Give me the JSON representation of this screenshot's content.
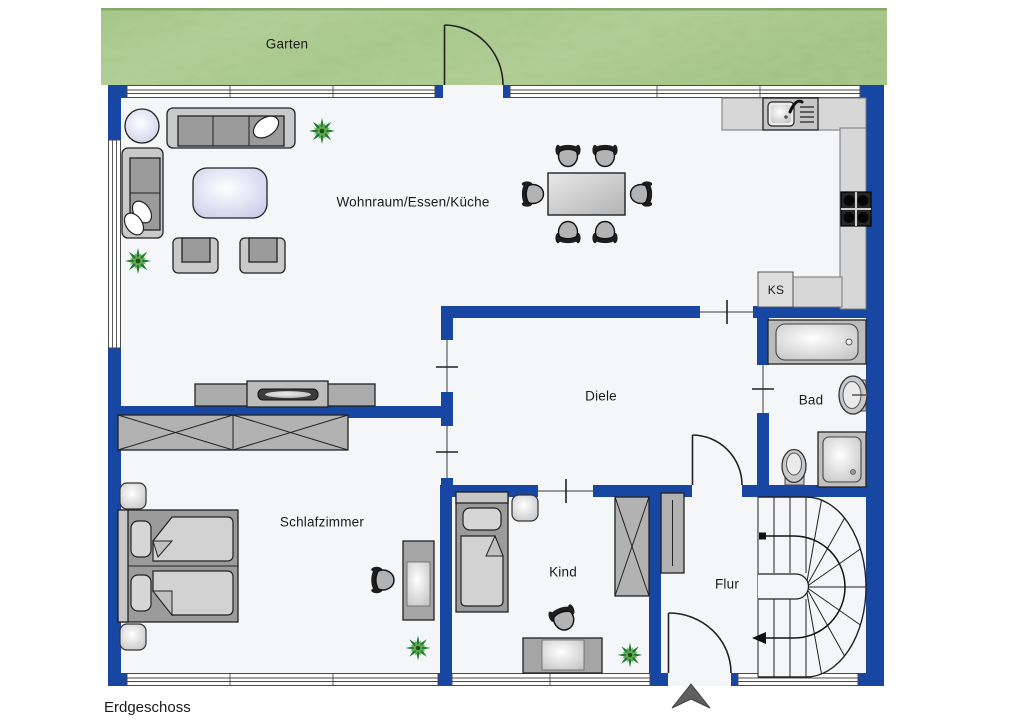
{
  "plan": {
    "floor_label": "Erdgeschoss",
    "garden": {
      "label": "Garten"
    },
    "rooms": {
      "living": {
        "label": "Wohnraum/Essen/Küche"
      },
      "hallway": {
        "label": "Diele"
      },
      "bath": {
        "label": "Bad"
      },
      "bedroom": {
        "label": "Schlafzimmer"
      },
      "child": {
        "label": "Kind"
      },
      "corridor": {
        "label": "Flur"
      },
      "fridge": {
        "label": "KS"
      }
    },
    "icons": [
      "north-arrow-icon",
      "stair-walking-line",
      "door-swing-arc"
    ]
  },
  "colors": {
    "wall": "#1747a3",
    "garden": "#a9c88d",
    "floor": "#f4f6f8",
    "furniture": "#9b9b9b",
    "furniture_light": "#c9c9c9",
    "counter": "#d7d7d7",
    "table_lilac": "#d6d6f0",
    "plant_green": "#1f7c35",
    "outline": "#2b2b2b",
    "text": "#1a1a1a"
  }
}
